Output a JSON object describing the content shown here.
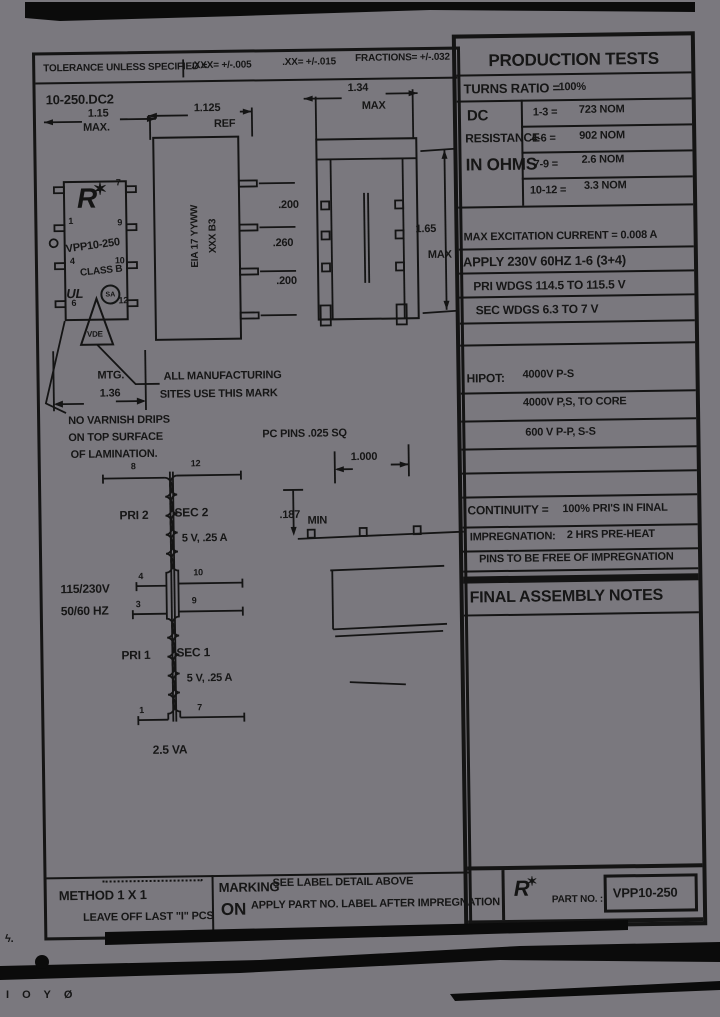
{
  "colors": {
    "paper": "#7a787e",
    "ink": "#141414"
  },
  "tolerance_bar": {
    "label": "TOLERANCE UNLESS SPECIFIED =",
    "xxx": ".XXX= +/-.005",
    "xx": ".XX= +/-.015",
    "fractions": "FRACTIONS= +/-.032"
  },
  "title_block": {
    "doc_number": "10-250.DC2"
  },
  "dimensions": {
    "width": "1.15",
    "width_suffix": "MAX.",
    "ref": "1.125",
    "ref_suffix": "REF",
    "length": "1.34",
    "length_suffix": "MAX",
    "height": "1.65",
    "height_suffix": "MAX",
    "pitch_a": ".200",
    "pitch_b": ".260",
    "pitch_c": ".200",
    "mtg_label": "MTG.",
    "mtg": "1.36",
    "row": "1.000",
    "standoff": ".187",
    "standoff_suffix": "MIN",
    "pc_pins": "PC PINS .025 SQ"
  },
  "label_box": {
    "logo_letter": "R",
    "star": "✶",
    "part": "VPP10-250",
    "class_rating": "CLASS B",
    "ul": "UL",
    "csa": "SA",
    "vde": "VDE",
    "pins_left": [
      "1",
      "4",
      "6"
    ],
    "pins_right": [
      "7",
      "9",
      "10",
      "12"
    ]
  },
  "side_marking": {
    "line1": "EIA 17 YYWW",
    "line2": "XXX      B3"
  },
  "notes": {
    "mark_1": "ALL MANUFACTURING",
    "mark_2": "SITES USE THIS MARK",
    "varnish_1": "NO VARNISH DRIPS",
    "varnish_2": "ON TOP SURFACE",
    "varnish_3": "OF LAMINATION."
  },
  "schematic": {
    "input_line1": "115/230V",
    "input_line2": "50/60 HZ",
    "pri2": "PRI 2",
    "sec2": "SEC 2",
    "sec2_rating": "5 V,  .25 A",
    "pri1": "PRI 1",
    "sec1": "SEC 1",
    "sec1_rating": "5 V,  .25 A",
    "va": "2.5 VA",
    "pin_top_left": "8",
    "pin_top_right": "12",
    "pin_mid1_left": "4",
    "pin_mid1_right": "10",
    "pin_mid2_left": "3",
    "pin_mid2_right": "9",
    "pin_bot_left": "1",
    "pin_bot_right": "7"
  },
  "production": {
    "title": "PRODUCTION TESTS",
    "turns_ratio_label": "TURNS RATIO =",
    "turns_ratio_value": "100%",
    "dc_line1": "DC",
    "dc_line2": "RESISTANCE",
    "dc_line3": "IN OHMS",
    "dc_rows": [
      {
        "pins": "1-3 =",
        "value": "723 NOM"
      },
      {
        "pins": "4-6 =",
        "value": "902 NOM"
      },
      {
        "pins": "7-9 =",
        "value": "2.6 NOM"
      },
      {
        "pins": "10-12 =",
        "value": "3.3 NOM"
      }
    ],
    "excitation": "MAX EXCITATION CURRENT = 0.008 A",
    "apply": "APPLY 230V 60HZ 1-6 (3+4)",
    "pri_wdgs": "PRI WDGS 114.5 TO 115.5 V",
    "sec_wdgs": "SEC WDGS 6.3 TO 7 V",
    "hipot_label": "HIPOT:",
    "hipot_1": "4000V  P-S",
    "hipot_2": "4000V  P,S, TO CORE",
    "hipot_3": "600 V P-P, S-S",
    "continuity_label": "CONTINUITY =",
    "continuity_value": "100% PRI'S IN FINAL",
    "impregnation_label": "IMPREGNATION:",
    "impregnation_value": "2 HRS PRE-HEAT",
    "pins_free": "PINS TO BE FREE OF IMPREGNATION",
    "final_assembly": "FINAL ASSEMBLY NOTES"
  },
  "footer": {
    "method_line1": "METHOD 1 X 1",
    "method_line2": "LEAVE OFF LAST \"I\" PCS",
    "marking_word": "MARKING",
    "marking_on": "ON",
    "marking_note1": "SEE LABEL DETAIL ABOVE",
    "marking_note2": "APPLY PART NO. LABEL AFTER IMPREGNATION",
    "logo_letter": "R",
    "star": "✶",
    "part_no_label": "PART NO. :",
    "part_no_value": "VPP10-250"
  },
  "artifacts": {
    "squiggle": "ϟ.",
    "bottom_glyphs": "Ι Ο Υ Ø"
  }
}
